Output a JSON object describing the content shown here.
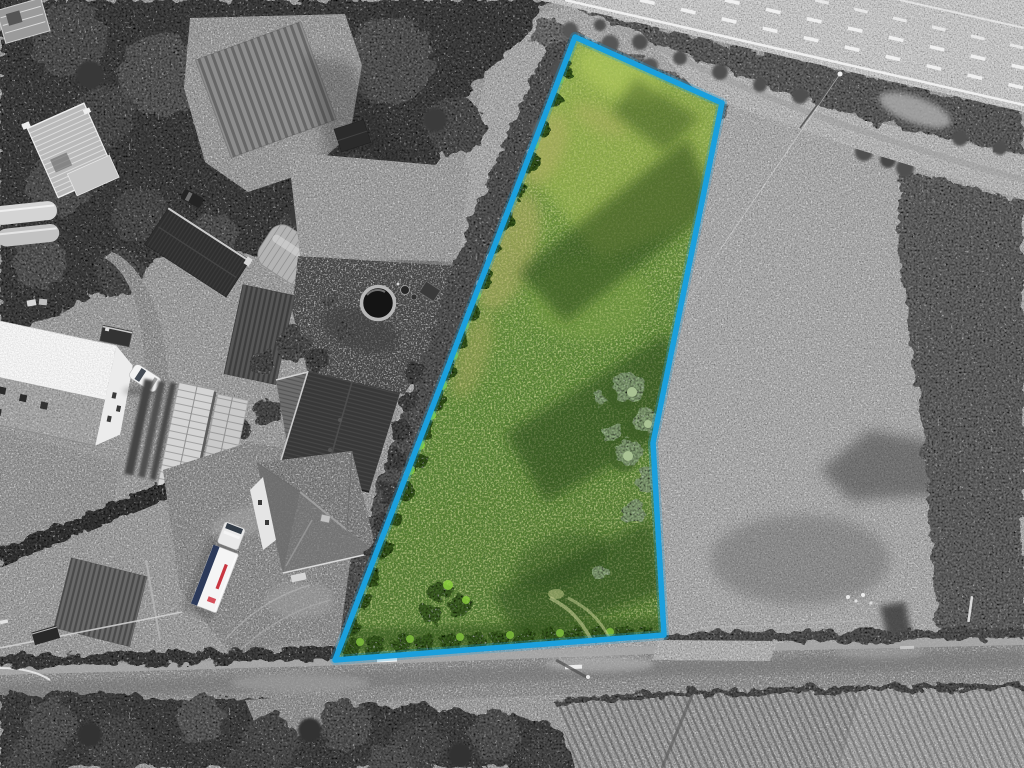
{
  "scene": {
    "kind": "aerial-drone-photograph",
    "treatment": "grayscale surroundings with colour-highlighted land parcel",
    "image": {
      "width": 1024,
      "height": 768
    }
  },
  "parcel": {
    "name": "highlighted-land-parcel",
    "outline_points": "575,37 722,103 653,443 664,635 335,660",
    "outline_color": "#1b9fdc",
    "outline_width": "5.5",
    "glow_width": "10",
    "grass_gradient": [
      "#96b350",
      "#7fa043",
      "#5d8636",
      "#51782f"
    ]
  },
  "colors": {
    "background": "#9c9c9c",
    "right_field": "#a9a9a9",
    "scrub_dark": "#6f6f6f",
    "woodland": "#4a4a4a",
    "bottom_woods": "#4b4b4b",
    "highway": "#c9c9c9",
    "service_road": "#b6b6b6",
    "bottom_road": "#8f8f8f",
    "lane_marking": "#f2f2f2",
    "dark_barn_roof": "#2f2f2f",
    "big_barn_roof": "#383838",
    "house_roof": "#7e7e7e",
    "white_barn_roof": "#dedede",
    "truck_trailer": "#f5f5f5",
    "truck_stripe": "#2c3a5a",
    "truck_logo_red": "#c32531",
    "lime_bush": "#8ed23f",
    "sage_tree": "#8fab7e"
  },
  "objects": {
    "parcel": "overgrown-grass-paddock",
    "road_top_right": "dual-carriageway",
    "road_parallel": "service-road",
    "road_bottom": "rural-lane",
    "farm": [
      "farmhouse",
      "big-barn",
      "dark-barn",
      "arched-greenhouse",
      "glasshouses",
      "polytunnels",
      "construction-house",
      "white-roof-barn"
    ],
    "vehicles": [
      "white-lorry",
      "white-car",
      "dark-car",
      "small-trailer"
    ],
    "garden": [
      "round-pool",
      "garden-beds",
      "shed"
    ],
    "vegetation": [
      "woodland-top-left",
      "woodland-bottom",
      "hedgerows",
      "crop-rows-field"
    ]
  }
}
